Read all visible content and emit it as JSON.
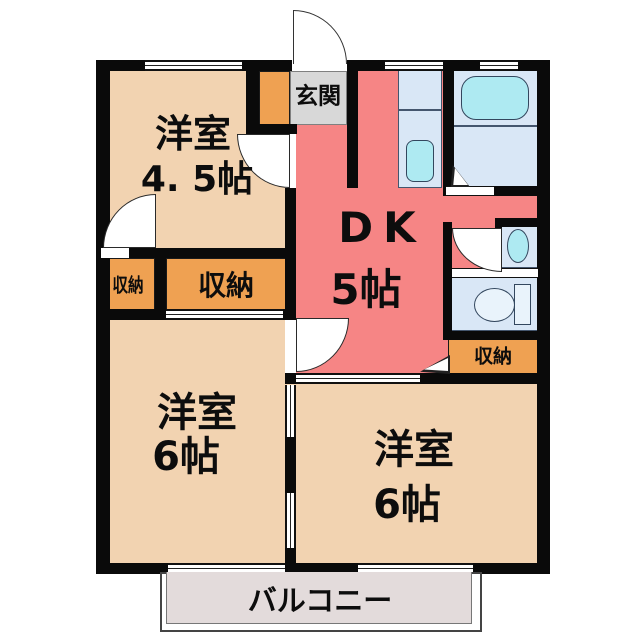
{
  "floorplan": {
    "rooms": {
      "western_nw": {
        "name": "洋室",
        "size": "4. 5帖"
      },
      "dining_kitchen": {
        "name": "DK",
        "size": "5帖"
      },
      "western_sw": {
        "name": "洋室",
        "size": "6帖"
      },
      "western_se": {
        "name": "洋室",
        "size": "6帖"
      }
    },
    "entrance_label": "玄関",
    "storage_label": "収納",
    "balcony_label": "バルコニー",
    "fixtures": [
      "bathtub",
      "kitchen-sink",
      "washbasin",
      "toilet"
    ],
    "colors": {
      "wall": "#0a0a0a",
      "western_room": "#f2d3b1",
      "dining_kitchen": "#f68585",
      "storage": "#efa152",
      "entrance": "#d8d8d8",
      "water_area": "#d9e7f6",
      "fixture": "#aeeaf2",
      "balcony": "#e3dbdb"
    }
  }
}
